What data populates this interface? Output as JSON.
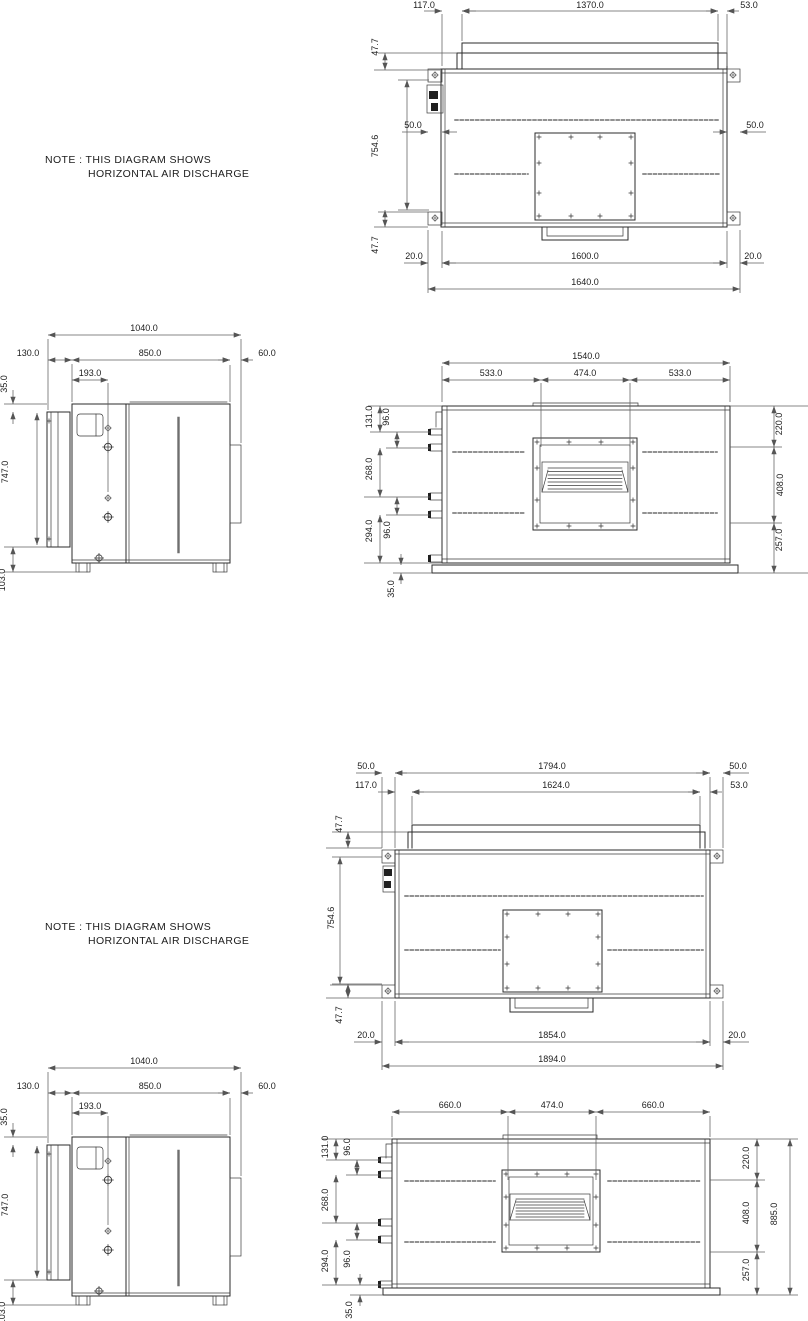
{
  "notes": {
    "unit1": {
      "line1": "NOTE : THIS DIAGRAM SHOWS",
      "line2": "HORIZONTAL AIR DISCHARGE"
    },
    "unit2": {
      "line1": "NOTE : THIS DIAGRAM SHOWS",
      "line2": "HORIZONTAL AIR DISCHARGE"
    }
  },
  "unit1": {
    "top_view": {
      "left_offset": "117.0",
      "coil_width": "1370.0",
      "right_offset": "53.0",
      "bracket_left": "50.0",
      "bracket_right": "50.0",
      "top_flange": "47.7",
      "body_depth": "754.6",
      "bottom_flange": "47.7",
      "foot_left": "20.0",
      "inner_width": "1600.0",
      "foot_right": "20.0",
      "overall_width": "1640.0"
    },
    "side_view": {
      "overall_depth": "1040.0",
      "rear_depth": "130.0",
      "body_depth": "850.0",
      "front_offset": "60.0",
      "pipe_offset": "193.0",
      "top_gap": "35.0",
      "panel_height": "747.0",
      "bottom_gap": "103.0"
    },
    "front_view": {
      "overall_width": "1540.0",
      "left_span": "533.0",
      "duct_width": "474.0",
      "right_span": "533.0",
      "pipe1": "131.0",
      "gap1": "96.0",
      "pipe_span": "268.0",
      "gap2": "96.0",
      "pipe2": "294.0",
      "base_gap": "35.0",
      "top_to_duct": "220.0",
      "duct_height": "408.0",
      "below_duct": "257.0",
      "overall_height": "885.0"
    }
  },
  "unit2": {
    "top_view": {
      "bracket_left": "50.0",
      "panel_width": "1794.0",
      "bracket_right": "50.0",
      "left_offset": "117.0",
      "coil_width": "1624.0",
      "right_offset": "53.0",
      "top_flange": "47.7",
      "body_depth": "754.6",
      "bottom_flange": "47.7",
      "foot_left": "20.0",
      "inner_width": "1854.0",
      "foot_right": "20.0",
      "overall_width": "1894.0"
    },
    "side_view": {
      "overall_depth": "1040.0",
      "rear_depth": "130.0",
      "body_depth": "850.0",
      "front_offset": "60.0",
      "pipe_offset": "193.0",
      "top_gap": "35.0",
      "panel_height": "747.0",
      "bottom_gap": "103.0"
    },
    "front_view": {
      "left_span": "660.0",
      "duct_width": "474.0",
      "right_span": "660.0",
      "pipe1": "131.0",
      "gap1": "96.0",
      "pipe_span": "268.0",
      "gap2": "96.0",
      "pipe2": "294.0",
      "base_gap": "35.0",
      "top_to_duct": "220.0",
      "duct_height": "408.0",
      "below_duct": "257.0",
      "overall_height": "885.0"
    }
  }
}
